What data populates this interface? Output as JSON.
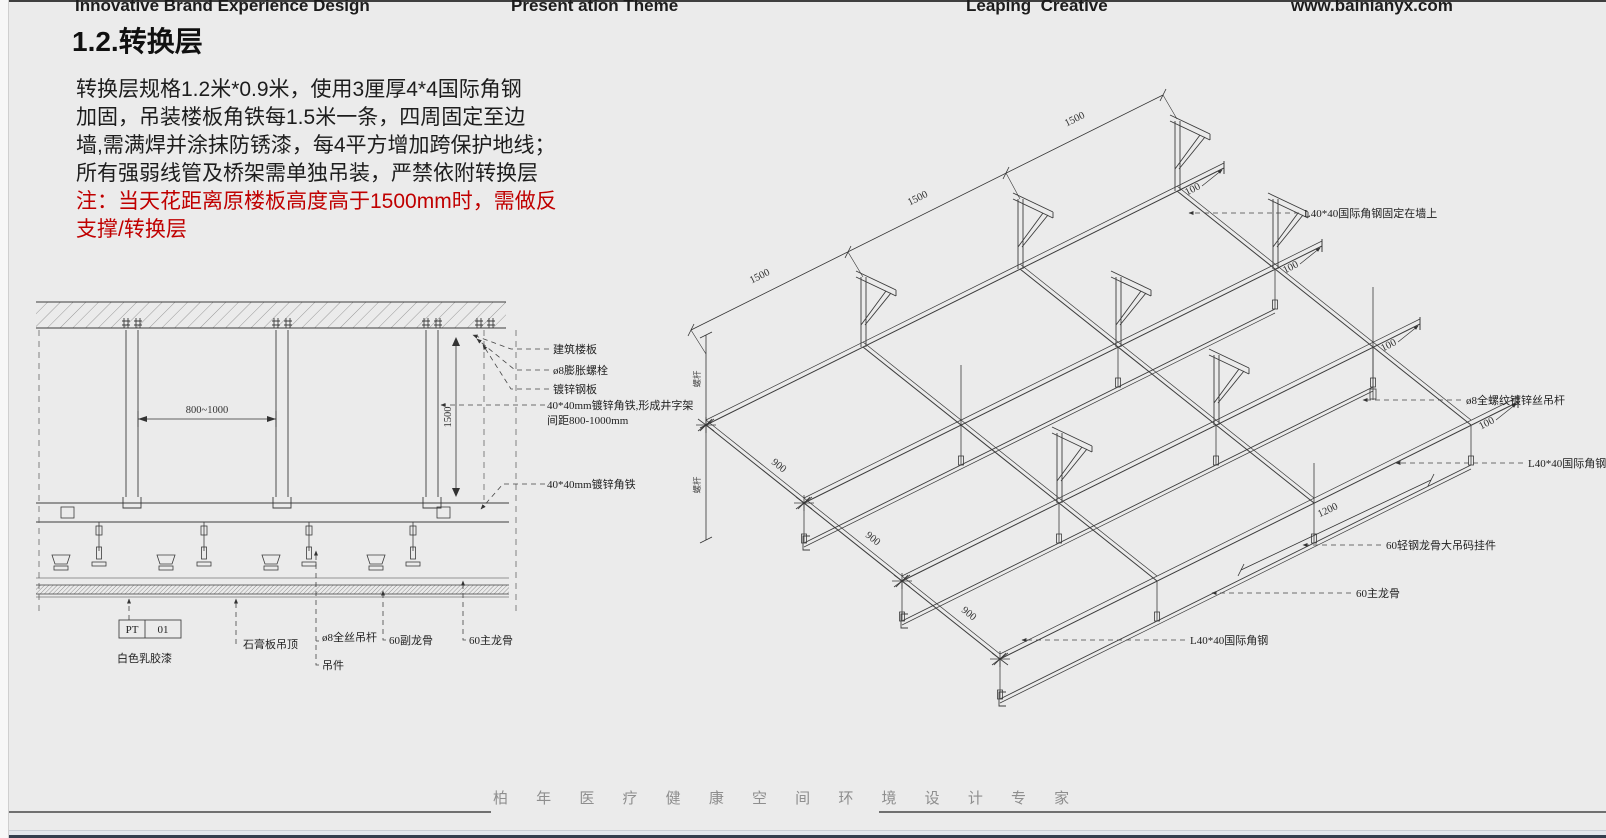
{
  "slide": {
    "header": {
      "item1": "Innovative Brand Experience Design",
      "item2": "Present ation Theme",
      "item3": "Leaping  Creative",
      "item4": "www.bainianyx.com"
    },
    "title": "1.2.转换层",
    "description": {
      "lines": [
        "转换层规格1.2米*0.9米，使用3厘厚4*4国际角钢",
        "加固，吊装楼板角铁每1.5米一条，四周固定至边",
        "墙,需满焊并涂抹防锈漆，每4平方增加跨保护地线；",
        "所有强弱线管及桥架需单独吊装，严禁依附转换层"
      ],
      "note_lines": [
        "注：当天花距离原楼板高度高于1500mm时，需做反",
        "支撑/转换层"
      ]
    },
    "footer_tagline": "柏 年 医 疗 健 康 空 间 环 境 设 计 专 家"
  },
  "section_diagram": {
    "dim_span": "800~1000",
    "dim_height": "1500",
    "labels": {
      "building_slab": "建筑楼板",
      "expansion_bolt": "ø8膨胀螺栓",
      "galvanized_plate": "镀锌钢板",
      "angle_iron_grid_1": "40*40mm镀锌角铁,形成井字架",
      "angle_iron_grid_2": "间距800-1000mm",
      "angle_iron": "40*40mm镀锌角铁",
      "paint_code_left": "PT",
      "paint_code_right": "01",
      "white_paint": "白色乳胶漆",
      "gypsum_ceiling": "石膏板吊顶",
      "full_thread_rod": "ø8全丝吊杆",
      "hanger_part": "吊件",
      "secondary_runner": "60副龙骨",
      "main_runner": "60主龙骨"
    }
  },
  "iso_diagram": {
    "dim_span": "1500",
    "dim_edge": "900",
    "dim_runner": "1200",
    "dim_stub": "100",
    "dim_rod": "螺杆",
    "labels": {
      "wall_angle": "L40*40国际角钢固定在墙上",
      "threaded_rod": "ø8全螺纹镀锌丝吊杆",
      "angle_steel_right": "L40*40国际角钢",
      "hanger_clip": "60轻钢龙骨大吊码挂件",
      "main_runner": "60主龙骨",
      "angle_steel_bottom": "L40*40国际角钢"
    }
  }
}
